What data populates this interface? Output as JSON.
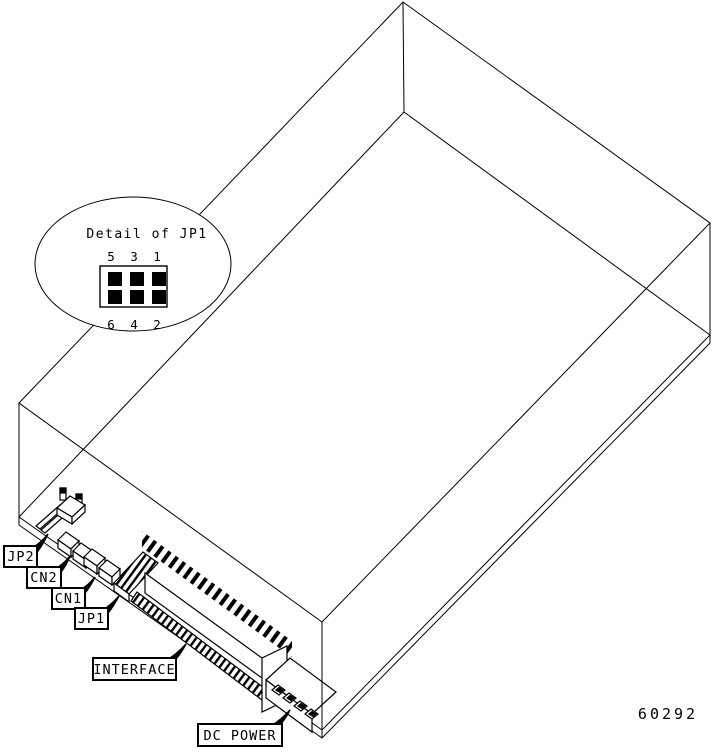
{
  "diagram": {
    "figure_number": "60292",
    "detail": {
      "title": "Detail of JP1",
      "top_pins": [
        "5",
        "3",
        "1"
      ],
      "bottom_pins": [
        "6",
        "4",
        "2"
      ]
    },
    "callouts": {
      "jp2": "JP2",
      "cn2": "CN2",
      "cn1": "CN1",
      "jp1": "JP1",
      "interface": "INTERFACE",
      "dc_power": "DC POWER"
    },
    "colors": {
      "line": "#000000",
      "background": "#ffffff"
    }
  }
}
